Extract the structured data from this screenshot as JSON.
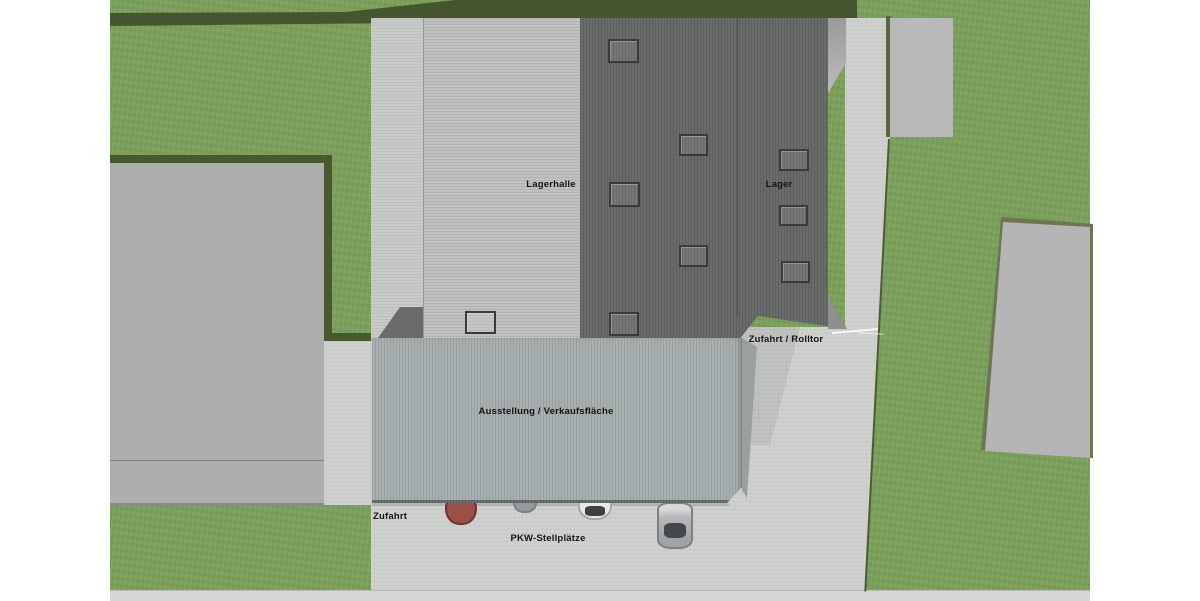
{
  "plan": {
    "areas": {
      "lagerhalle": {
        "label": "Lagerhalle"
      },
      "lager": {
        "label": "Lager"
      },
      "zufahrt_rolltor": {
        "label": "Zufahrt / Rolltor"
      },
      "ausstellung_verkaufsflaeche": {
        "label": "Ausstellung / Verkaufsfläche"
      },
      "zufahrt": {
        "label": "Zufahrt"
      },
      "pkw_stellplaetze": {
        "label": "PKW-Stellplätze"
      }
    },
    "colors": {
      "background": "#ffffff",
      "grass": "#7ca05c",
      "hedge": "#48592f",
      "pavement": "#d0d2d0",
      "pavement_strip": "#c9cbc9",
      "roof_light": "#bfc1bf",
      "roof_dark": "#676969",
      "roof_showroom": "#a9b0b0",
      "neighbor_building": "#b5b5b5",
      "shadow": "#6b6b6b"
    },
    "skylights": [
      {
        "x": 608,
        "y": 39,
        "w": 27,
        "h": 20
      },
      {
        "x": 679,
        "y": 134,
        "w": 25,
        "h": 18
      },
      {
        "x": 609,
        "y": 182,
        "w": 27,
        "h": 21
      },
      {
        "x": 679,
        "y": 245,
        "w": 25,
        "h": 18
      },
      {
        "x": 609,
        "y": 312,
        "w": 26,
        "h": 20
      },
      {
        "x": 779,
        "y": 149,
        "w": 26,
        "h": 18
      },
      {
        "x": 779,
        "y": 205,
        "w": 25,
        "h": 17
      },
      {
        "x": 781,
        "y": 261,
        "w": 25,
        "h": 18
      },
      {
        "x": 465,
        "y": 311,
        "w": 27,
        "h": 19
      }
    ],
    "cars": [
      {
        "name": "red",
        "body": "#9c4f49",
        "outline": "#6e322e",
        "x": 445,
        "y": 496,
        "w": 28,
        "h": 25
      },
      {
        "name": "gray",
        "body": "#949a9e",
        "outline": "#7b8185",
        "x": 513,
        "y": 495,
        "w": 20,
        "h": 14
      },
      {
        "name": "white",
        "body": "#e9e9e7",
        "outline": "#a8a8a6",
        "x": 578,
        "y": 495,
        "w": 30,
        "h": 21,
        "window": {
          "x": 5,
          "y": 9,
          "w": 20,
          "h": 10,
          "color": "#3f3f3f"
        }
      },
      {
        "name": "silver",
        "body": "#b7b9bb",
        "outline": "#7e8082",
        "x": 657,
        "y": 502,
        "w": 32,
        "h": 43,
        "window": {
          "x": 5,
          "y": 19,
          "w": 22,
          "h": 15,
          "color": "#44484c"
        }
      }
    ]
  }
}
